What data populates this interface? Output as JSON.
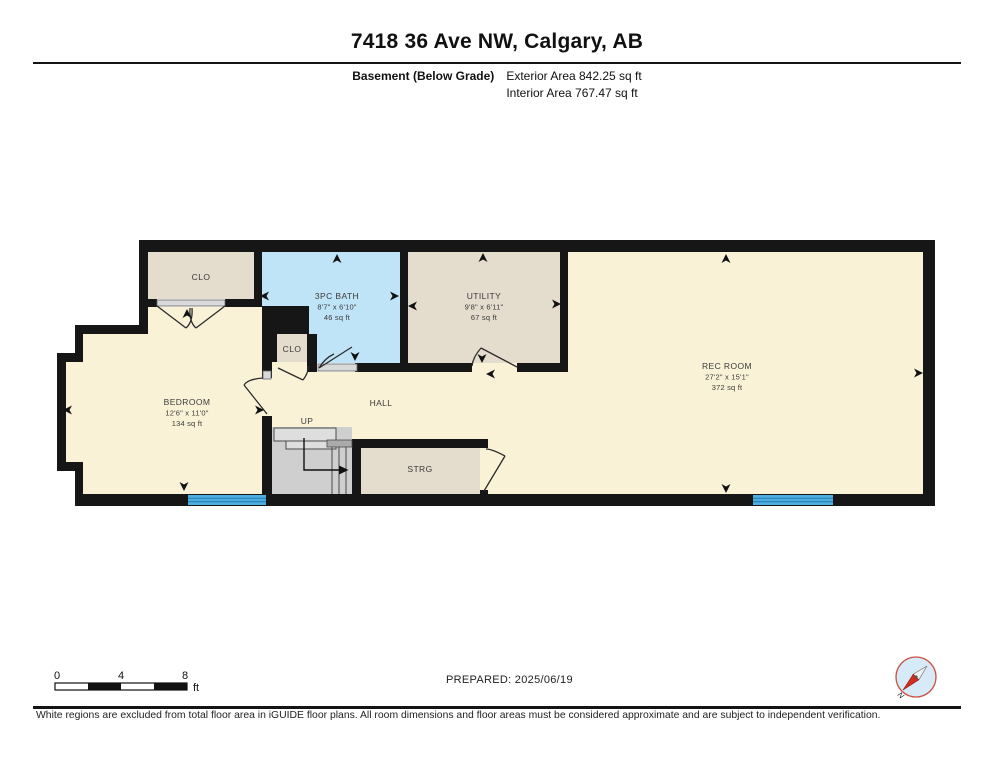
{
  "header": {
    "title": "7418 36 Ave NW, Calgary, AB",
    "floor_label": "Basement (Below Grade)",
    "exterior_area": "Exterior Area 842.25 sq ft",
    "interior_area": "Interior Area 767.47 sq ft"
  },
  "rooms": {
    "clo_upper": {
      "name": "CLO"
    },
    "bath": {
      "name": "3PC BATH",
      "dims": "8'7\" x 6'10\"",
      "area": "46 sq ft"
    },
    "utility": {
      "name": "UTILITY",
      "dims": "9'8\" x 6'11\"",
      "area": "67 sq ft"
    },
    "rec_room": {
      "name": "REC ROOM",
      "dims": "27'2\" x 15'1\"",
      "area": "372 sq ft"
    },
    "bedroom": {
      "name": "BEDROOM",
      "dims": "12'6\" x 11'0\"",
      "area": "134 sq ft"
    },
    "clo_small": {
      "name": "CLO"
    },
    "hall": {
      "name": "HALL"
    },
    "up_label": "UP",
    "strg": {
      "name": "STRG"
    }
  },
  "footer": {
    "scale": {
      "start": "0",
      "mid": "4",
      "end": "8",
      "unit": "ft"
    },
    "prepared": "PREPARED: 2025/06/19",
    "compass_north": "N",
    "disclaimer": "White regions are excluded from total floor area in iGUIDE floor plans. All room dimensions and floor areas must be considered approximate and are subject to independent verification."
  },
  "colors": {
    "wall": "#161616",
    "floor_cream": "#faf2d7",
    "floor_tan": "#e4dccd",
    "bath_blue": "#bfe4f7",
    "window_blue": "#4fafe0",
    "stair_grey": "#cfcfcf",
    "compass_red": "#c94f44",
    "compass_disc": "#d7eaf7"
  }
}
